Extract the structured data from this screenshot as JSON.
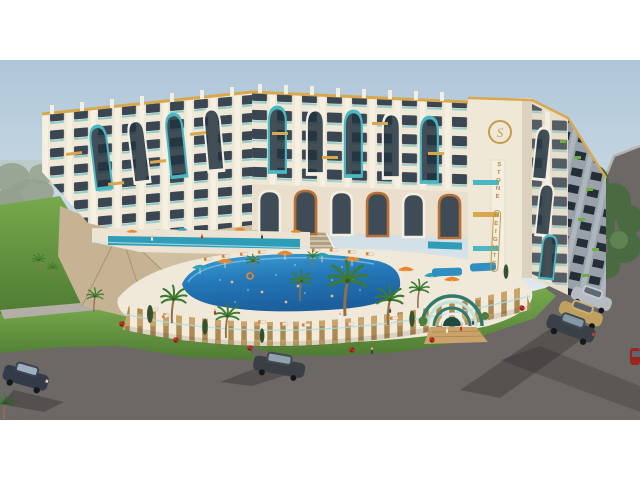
{
  "scene": {
    "kind": "aerial 3d architectural rendering of a curved resort apartment complex with pools",
    "signage": {
      "building_name": "STONE HEIGHTS",
      "name_line1": "STONE",
      "name_line2": "HEIGHTS",
      "logo_monogram": "S"
    },
    "lighting": "low sun from upper right, long shadows cast toward lower left",
    "frame": {
      "width_px": 640,
      "photo_height_px": 360,
      "letterbox_top_px": 60,
      "letterbox_bottom_px": 60
    },
    "inventory": {
      "floors_visible": 6,
      "parked_cars_right": 3,
      "cars_on_road": 2,
      "partial_car_right_edge": 1,
      "swimming_pools": 2,
      "entrance_arch_pavilion": 1,
      "podium_staircase": 1
    },
    "palette": {
      "page_bg": "#ffffff",
      "sky_top": "#aec6d8",
      "sky_horizon": "#e3ebee",
      "facade_cream": "#f0e8d7",
      "facade_shade": "#d8cdb9",
      "facade_dark_side": "#99a1aa",
      "window_glass": "#3a4652",
      "accent_teal": "#49b8c2",
      "accent_gold": "#d9a84e",
      "copper": "#b86f35",
      "stone_tan": "#c6b394",
      "lawn_green": "#5f8f3e",
      "lawn_light": "#76a94c",
      "pool_deep": "#1c5f9d",
      "pool_light": "#3fa0d6",
      "deck_cream": "#f0e8d8",
      "wall_tan": "#c9a56c",
      "road_gray": "#6c6865",
      "sidewalk_gray": "#b3aea6",
      "umbrella_orange": "#e8872b",
      "umbrella_teal": "#2fa3b0",
      "tree_green": "#4a6b41",
      "tree_haze": "#95a18f",
      "car_dark": "#343b48",
      "car_silver": "#b6bcc2",
      "car_gold": "#c0a05f",
      "car_red": "#9c241f"
    }
  }
}
